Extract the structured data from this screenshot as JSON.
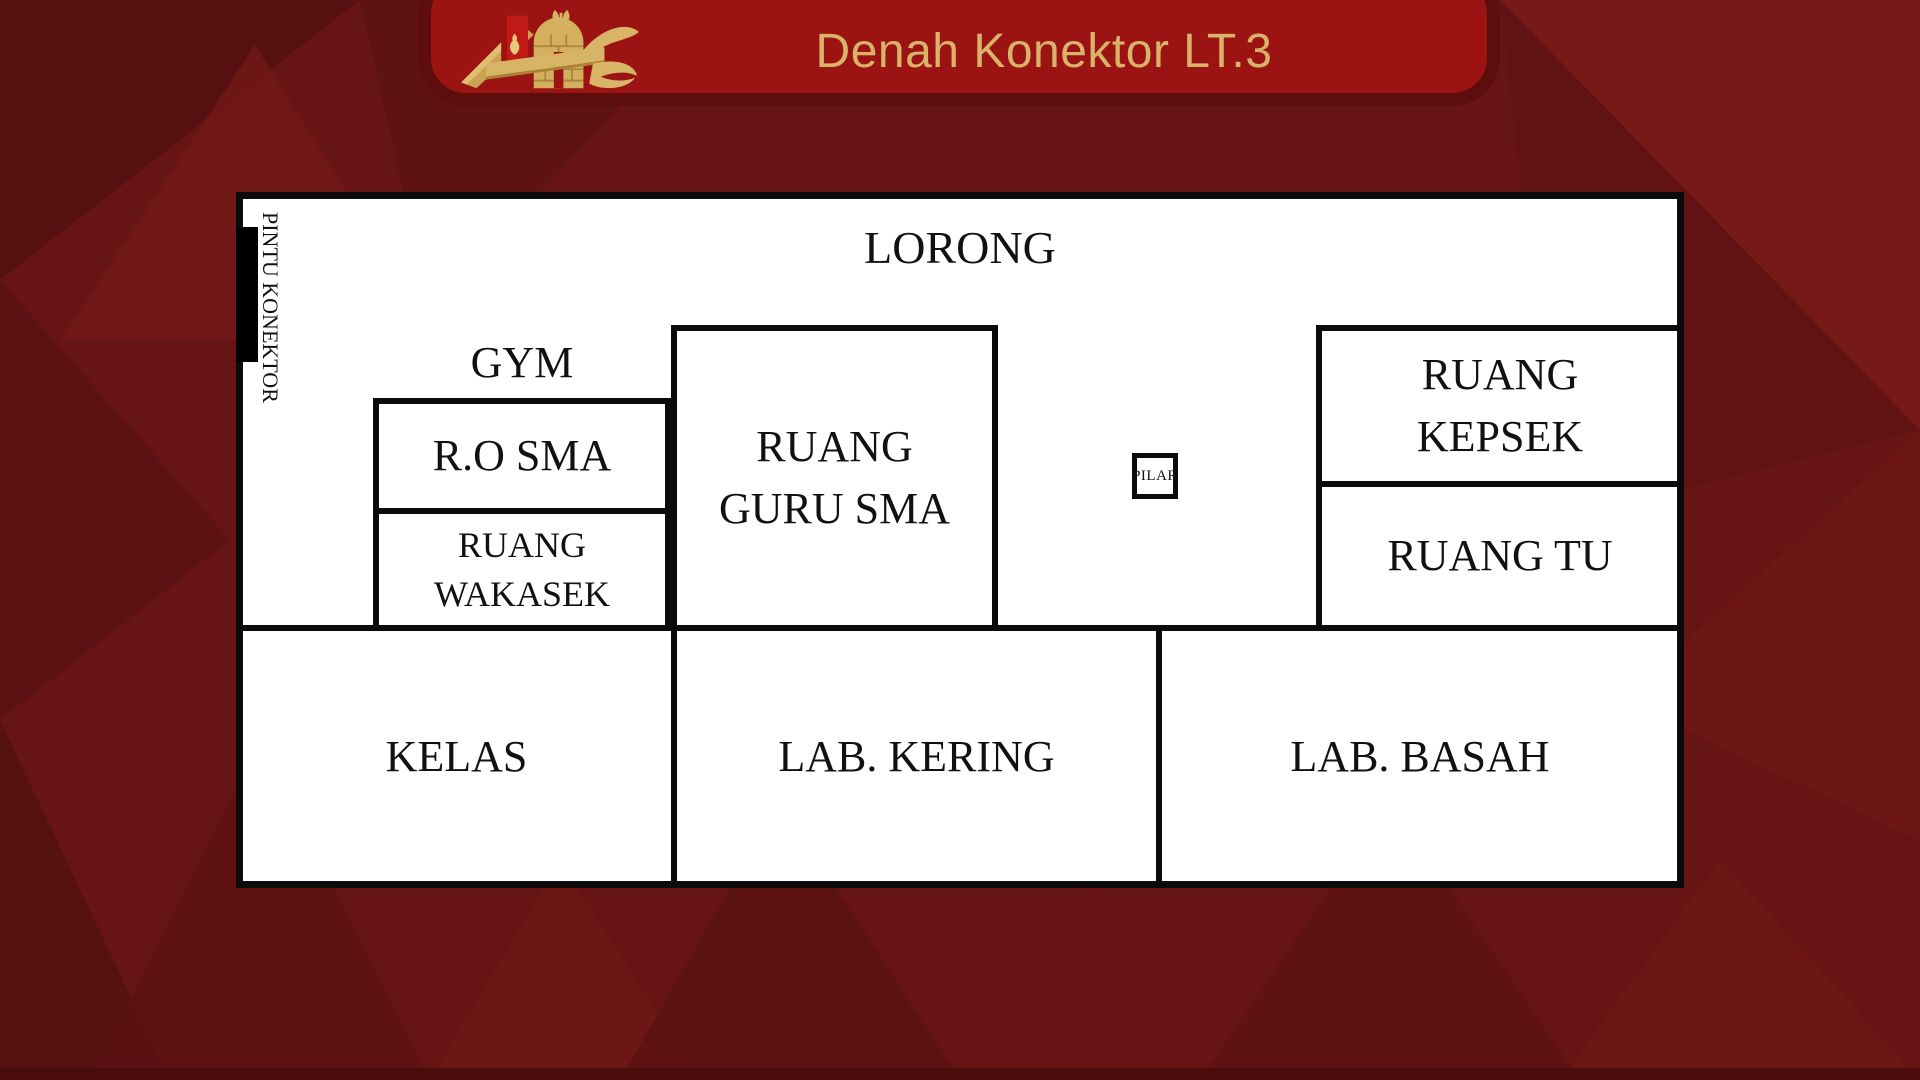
{
  "header": {
    "title": "Denah Konektor LT.3"
  },
  "floor_plan": {
    "corridor_label": "LORONG",
    "connector_door_label": "PINTU KONEKTOR",
    "rooms": {
      "gym": "GYM",
      "ro_sma": "R.O SMA",
      "wakasek_line1": "RUANG",
      "wakasek_line2": "WAKASEK",
      "guru_line1": "RUANG",
      "guru_line2": "GURU SMA",
      "pilar": "PILAR",
      "kepsek_line1": "RUANG",
      "kepsek_line2": "KEPSEK",
      "tu": "RUANG TU",
      "kelas": "KELAS",
      "lab_kering": "LAB. KERING",
      "lab_basah": "LAB. BASAH"
    }
  },
  "colors": {
    "background_red": "#671414",
    "banner_red": "#9B1413",
    "banner_border": "#5E0D0D",
    "title_gold": "#D9B369",
    "logo_gold": "#D3AF5E",
    "logo_ribbon_red": "#C01A16",
    "plan_white": "#FFFFFF",
    "wall_black": "#0B0B0B"
  }
}
